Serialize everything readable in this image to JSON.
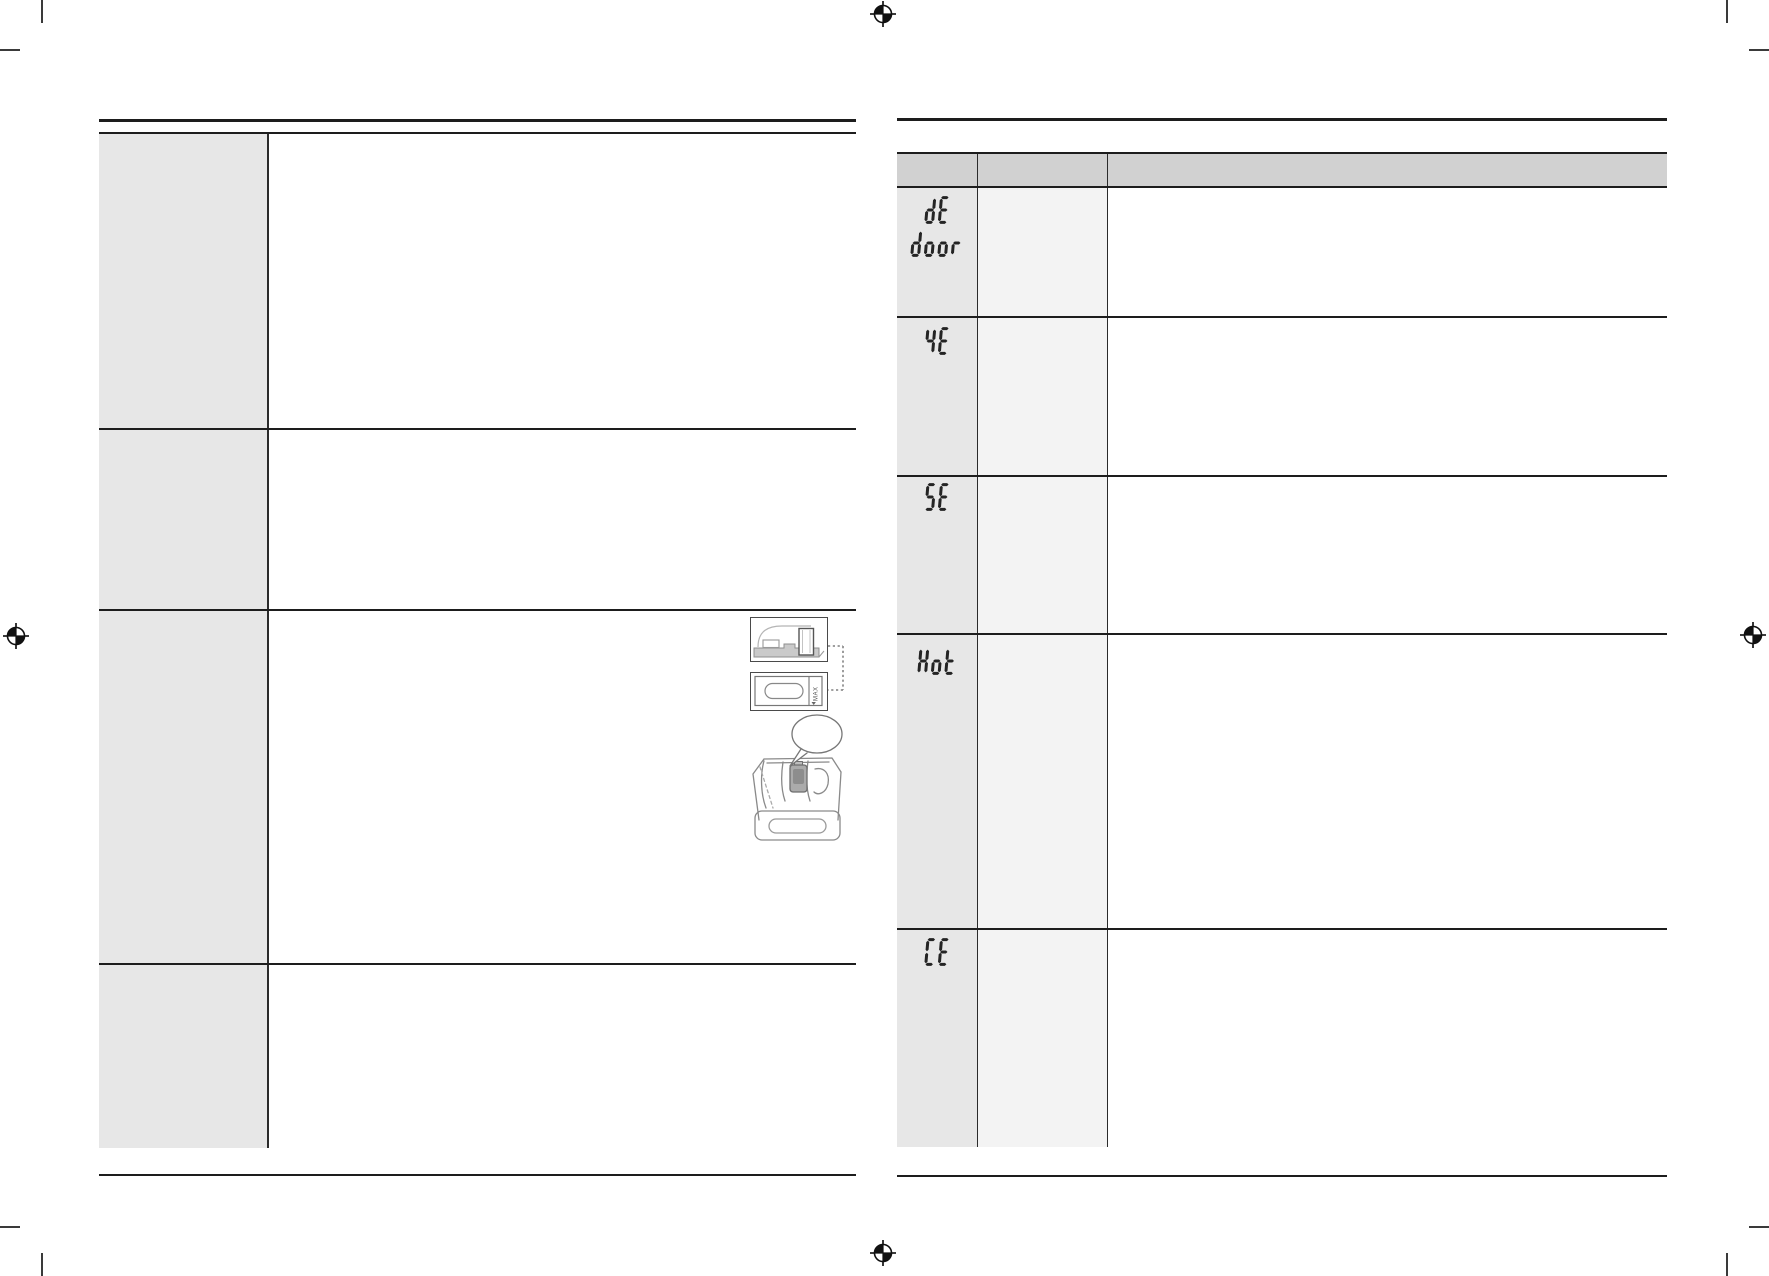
{
  "colors": {
    "rule": "#1d1d1d",
    "table_header_bg": "#d1d1d1",
    "code_column_bg": "#e7e7e7",
    "middle_column_bg": "#f3f3f3",
    "content_bg": "#ffffff",
    "segment_glyph": "#242424",
    "sketch_stroke": "#8a8a8a"
  },
  "left_page": {
    "row_count": 4,
    "rows": [
      {
        "label_text": ""
      },
      {
        "label_text": ""
      },
      {
        "label_text": ""
      },
      {
        "label_text": ""
      }
    ]
  },
  "right_page": {
    "header": {
      "columns": [
        "",
        "",
        ""
      ]
    },
    "rows": [
      {
        "code_lines": [
          "dE",
          "door"
        ]
      },
      {
        "code_lines": [
          "4E"
        ]
      },
      {
        "code_lines": [
          "5E"
        ]
      },
      {
        "code_lines": [
          "Hot"
        ]
      },
      {
        "code_lines": [
          "CE"
        ]
      }
    ]
  },
  "figures": {
    "detergent_max_label": "MAX"
  }
}
